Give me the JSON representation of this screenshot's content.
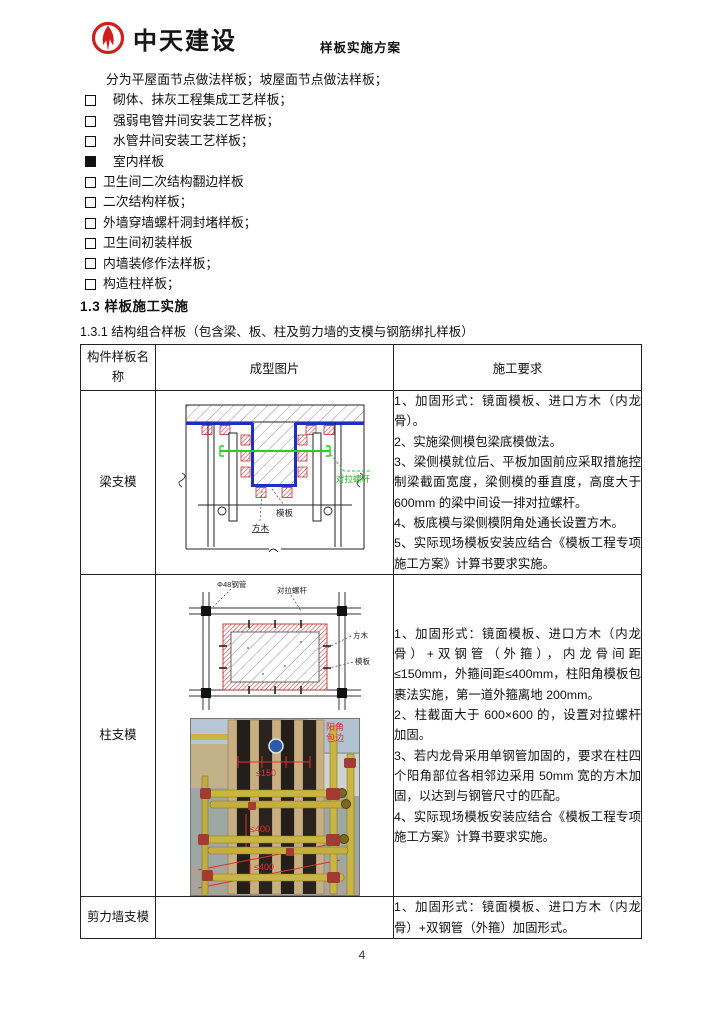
{
  "header": {
    "logo_text": "中天建设",
    "doc_title": "样板实施方案"
  },
  "intro": "分为平屋面节点做法样板；坡屋面节点做法样板；",
  "checklist": [
    {
      "label": "砌体、抹灰工程集成工艺样板；",
      "checked": false
    },
    {
      "label": "强弱电管井间安装工艺样板；",
      "checked": false
    },
    {
      "label": "水管井间安装工艺样板；",
      "checked": false
    },
    {
      "label": "室内样板",
      "checked": true
    },
    {
      "label": "卫生间二次结构翻边样板",
      "checked": false
    },
    {
      "label": "二次结构样板；",
      "checked": false
    },
    {
      "label": "外墙穿墙螺杆洞封堵样板；",
      "checked": false
    },
    {
      "label": "卫生间初装样板",
      "checked": false
    },
    {
      "label": "内墙装修作法样板；",
      "checked": false
    },
    {
      "label": "构造柱样板；",
      "checked": false
    }
  ],
  "sections": {
    "h2": "1.3 样板施工实施",
    "h3": "1.3.1 结构组合样板（包含梁、板、柱及剪力墙的支模与钢筋绑扎样板）"
  },
  "table": {
    "headers": [
      "构件样板名称",
      "成型图片",
      "施工要求"
    ],
    "rows": [
      {
        "name": "梁支模",
        "requirements": [
          "1、加固形式：镜面模板、进口方木（内龙骨）。",
          "2、实施梁侧模包梁底模做法。",
          "3、梁侧模就位后、平板加固前应采取措施控制梁截面宽度，梁侧模的垂直度，高度大于 600mm 的梁中间设一排对拉螺杆。",
          "4、板底模与梁侧模阴角处通长设置方木。",
          "5、实际现场模板安装应结合《模板工程专项施工方案》计算书要求实施。"
        ]
      },
      {
        "name": "柱支模",
        "requirements": [
          "1、加固形式：镜面模板、进口方木（内龙骨）+双钢管（外箍），内龙骨间距≤150mm，外箍间距≤400mm，柱阳角模板包裹法实施，第一道外箍离地 200mm。",
          "2、柱截面大于 600×600 的，设置对拉螺杆加固。",
          "3、若内龙骨采用单钢管加固的，要求在柱四个阳角部位各相邻边采用 50mm 宽的方木加固，以达到与钢管尺寸的匹配。",
          "4、实际现场模板安装应结合《模板工程专项施工方案》计算书要求实施。"
        ]
      },
      {
        "name": "剪力墙支模",
        "requirements": [
          "1、加固形式：镜面模板、进口方木（内龙骨）+双钢管（外箍）加固形式。"
        ]
      }
    ]
  },
  "beam_diagram": {
    "tie_rod_label": "对拉螺杆",
    "formwork_label": "模板",
    "timber_label": "方木"
  },
  "column_diagram": {
    "pipe_label": "Φ48钢管",
    "tie_rod_label": "对拉螺杆",
    "timber_label": "方木",
    "formwork_label": "模板"
  },
  "column_photo": {
    "corner_label_line1": "阳角",
    "corner_label_line2": "包边",
    "dim_top": "≤150",
    "dim_mid": "≤400",
    "dim_bottom": "≤400"
  },
  "colors": {
    "brand_red": "#cf1f1f",
    "formwork_blue": "#1f2fbf",
    "timber_red": "#d03030",
    "tie_rod_green": "#1fd41f",
    "annotation_red": "#e03030"
  },
  "footer": {
    "page_number": "4"
  }
}
